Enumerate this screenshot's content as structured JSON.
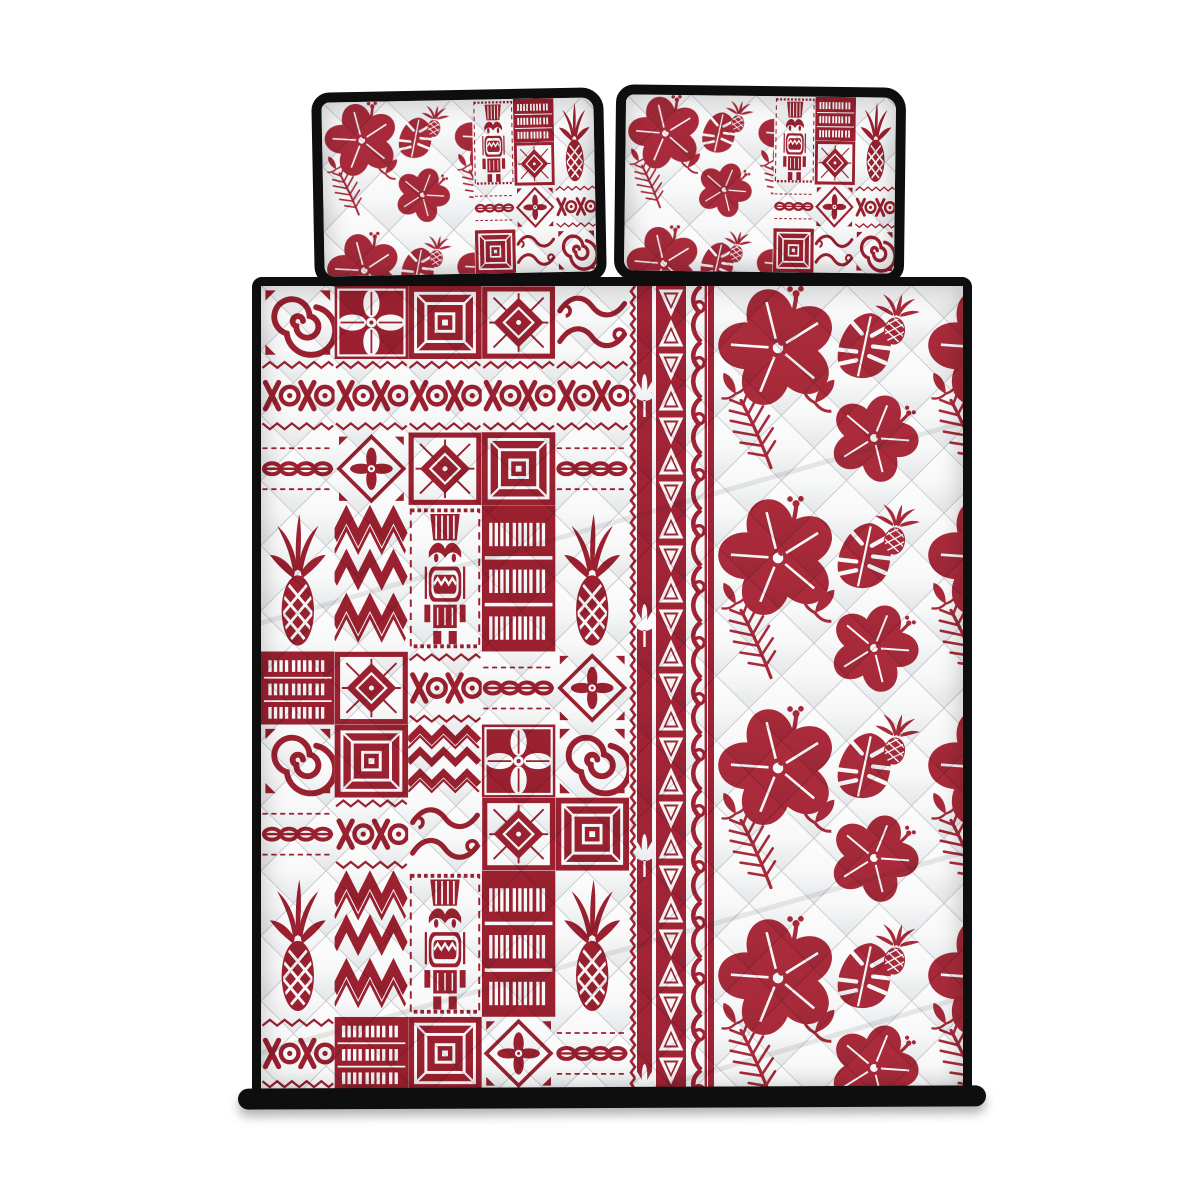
{
  "scene": {
    "label": "Hawaiian tapa tribal pattern quilt bed set in red and white, shown on a plain white background",
    "items_visible": "two pillow shams and one quilt cover"
  },
  "colors": {
    "page_bg": "#ffffff",
    "tapa_red": "#9E2130",
    "flower_red": "#AC2B3B",
    "band_red": "#A32436",
    "cloth_white": "#FDFDFD",
    "seam_gray": "#878C92",
    "shade_gray": "#CED2D5",
    "trim_black": "#0E0E0E"
  },
  "parts": {
    "pillow_left_label": "pillow sham (left) — hibiscus half and tapa patchwork half with black piping",
    "pillow_right_label": "pillow sham (right) — hibiscus half and tapa patchwork half with black piping",
    "quilt_label": "quilt cover — tapa patchwork panel, tribal border band, hibiscus panel, black piping",
    "left_panel_label": "tapa patchwork panel with tiki, pineapple and geometric patches",
    "band_label": "vertical Polynesian border band with zigzag, triangle and wave stripes",
    "right_panel_label": "quilted white panel with red hibiscus, monstera and palm fronds",
    "hem_label": "black binding hem at the foot of the quilt"
  },
  "patterns": {
    "motif_names": [
      "spiral",
      "leaf4",
      "geo",
      "star",
      "waves",
      "xoxo",
      "chain",
      "flower",
      "chevron",
      "tiki",
      "hash",
      "pineapple"
    ],
    "patchwork_main": {
      "cell_w": 73.6,
      "cell_h": 73.18,
      "tiles": [
        [
          "spiral",
          "leaf4",
          "geo",
          "star",
          "waves"
        ],
        [
          "xoxo",
          "xoxo",
          "xoxo",
          "xoxo",
          "xoxo"
        ],
        [
          "chain",
          "flower",
          "star",
          "geo",
          "chain"
        ],
        [
          "pineapple!",
          "chevron!",
          "tiki!",
          "hash!",
          "pineapple!"
        ],
        [
          ".",
          ".",
          ".",
          ".",
          "."
        ],
        [
          "hash",
          "star",
          "xoxo",
          "chain",
          "flower"
        ],
        [
          "spiral",
          "geo",
          "chevron",
          "leaf4",
          "spiral"
        ],
        [
          "chain",
          "xoxo",
          "waves",
          "star",
          "geo"
        ],
        [
          "pineapple!",
          "chevron!",
          "tiki!",
          "hash!",
          "pineapple!"
        ],
        [
          ".",
          ".",
          ".",
          ".",
          "."
        ],
        [
          "xoxo",
          "hash",
          "geo",
          "flower",
          "chain"
        ]
      ]
    },
    "patchwork_pillow": {
      "cell_w": 40.5,
      "cell_h": 43,
      "tiles": [
        [
          "tiki!",
          "hash",
          "pineapple!"
        ],
        [
          ".",
          "star",
          "."
        ],
        [
          "chain",
          "flower",
          "xoxo"
        ],
        [
          "geo",
          "waves",
          "spiral"
        ]
      ]
    }
  }
}
